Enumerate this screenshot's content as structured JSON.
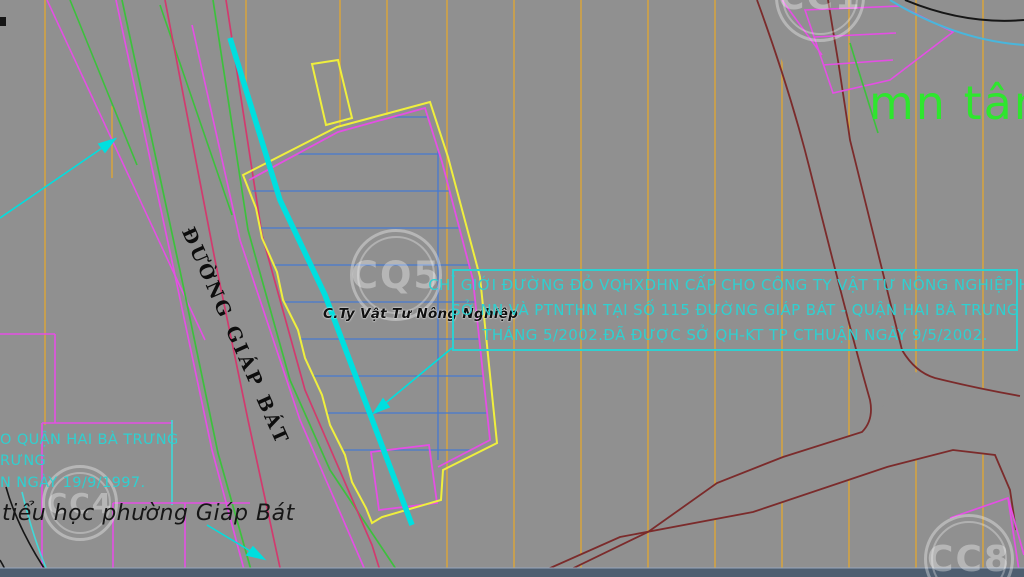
{
  "map": {
    "road_label": "ĐƯỜNG GIÁP BÁT",
    "site_label": "C.Ty Vật Tư Nông Nghiệp",
    "green_area_label": "mn tân",
    "school_label": "tiểu học phường Giáp Bát",
    "note_box": {
      "line1": "CHỈ GIỚI ĐƯỜNG ĐỎ VQHXDHN CẤP CHO CÔNG TY VẬT TƯ NÔNG NGHIỆP HN",
      "line2": "SỞ NN VÀ PTNTHN TẠI SỐ 115 ĐƯỜNG GIÁP BÁT - QUẬN HAI BÀ TRƯNG",
      "line3": "THÁNG 5/2002.ĐÃ ĐƯỢC SỞ QH-KT TP CTHUẬN NGÀY 9/5/2002."
    },
    "left_note": {
      "line1": "O QUẬN HAI BÀ TRƯNG",
      "line2": "RƯNG",
      "line3": "N NGÀY 19/9/1997."
    },
    "watermarks": {
      "center": "CQ5",
      "bottom_left": "CC4",
      "bottom_right": "CC8",
      "top_right_partial": "CC1"
    },
    "colors": {
      "background": "#909090",
      "grid_orange": "#d8a43c",
      "boundary_yellow": "#efef3d",
      "magenta": "#e44fe4",
      "green": "#3cc13c",
      "crimson": "#d23a6e",
      "cyan_line": "#00dfdf",
      "note_cyan": "#2fd0d0",
      "hatch_blue": "#4679cf",
      "road_maroon": "#7b2b2b",
      "label_green": "#2ee62e",
      "bottom_bar": "#4e5e70"
    }
  }
}
